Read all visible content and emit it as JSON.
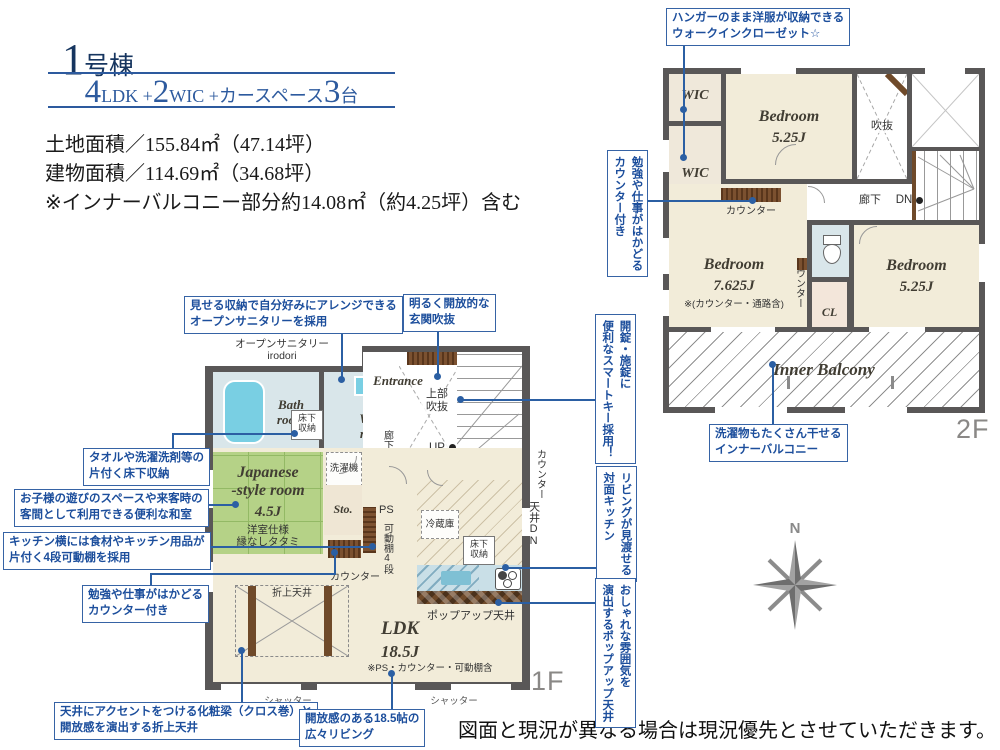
{
  "header": {
    "building_num": "1",
    "building_suffix": "号棟",
    "sub_n1": "4",
    "sub_u1": "LDK +",
    "sub_n2": "2",
    "sub_u2": "WIC +カースペース",
    "sub_n3": "3",
    "sub_u3": "台",
    "areas": "土地面積／155.84㎡（47.14坪）\n建物面積／114.69㎡（34.68坪）\n※インナーバルコニー部分約14.08㎡（約4.25坪）含む"
  },
  "floor2": {
    "label": "2F",
    "wic1": "WIC",
    "wic2": "WIC",
    "bed1_name": "Bedroom",
    "bed1_size": "5.25J",
    "void": "吹抜",
    "hall": "廊下",
    "dn": "DN",
    "counter_top": "カウンター",
    "bed2_name": "Bedroom",
    "bed2_size": "7.625J",
    "bed2_note": "※(カウンター・通路含)",
    "counter_side": "カウンター",
    "cl": "CL",
    "bed3_name": "Bedroom",
    "bed3_size": "5.25J",
    "balcony": "Inner Balcony"
  },
  "floor1": {
    "label": "1F",
    "sanitary_label": "オープンサニタリー\nirodori",
    "bath": "Bath\nroom",
    "wash": "Wash\nroom",
    "floor_storage1": "床下\n収納",
    "entrance": "Entrance",
    "upper_void": "上部\n吹抜",
    "hall": "廊下",
    "up": "UP",
    "washer": "洗濯機",
    "jp_name": "Japanese\n-style room",
    "jp_size": "4.5J",
    "jp_note": "洋室仕様\n縁なしタタミ",
    "sto1": "Sto.",
    "sto2": "Sto.",
    "ps": "PS",
    "shelf": "可動棚4段",
    "fridge": "冷蔵庫",
    "floor_storage2": "床下\n収納",
    "counter": "カウンター",
    "wc_counter": "カウンター",
    "ceiling_dn": "天井DN",
    "oriage": "折上天井",
    "ldk_name": "LDK",
    "ldk_size": "18.5J",
    "ldk_note": "※PS・カウンター・可動棚含",
    "popup": "ポップアップ天井",
    "shutter1": "シャッター",
    "shutter2": "シャッター"
  },
  "callouts": {
    "wic": "ハンガーのまま洋服が収納できる\nウォークインクローゼット☆",
    "study2f": "勉強や仕事がはかどる\nカウンター付き",
    "smartkey": "開錠・施錠に\n便利なスマートキー採用！",
    "kitchen_face": "リビングが見渡せる\n対面キッチン",
    "popup": "おしゃれな雰囲気を\n演出するポップアップ天井",
    "balcony": "洗濯物もたくさん干せる\nインナーバルコニー",
    "sanitary": "見せる収納で自分好みにアレンジできる\nオープンサニタリーを採用",
    "genkan": "明るく開放的な\n玄関吹抜",
    "yukashita": "タオルや洗濯洗剤等の\n片付く床下収納",
    "washitsu": "お子様の遊びのスペースや来客時の\n客間として利用できる便利な和室",
    "kadoudana": "キッチン横には食材やキッチン用品が\n片付く4段可動棚を採用",
    "study1f": "勉強や仕事がはかどる\nカウンター付き",
    "keshobari": "天井にアクセントをつける化粧梁（クロス巻）と\n開放感を演出する折上天井",
    "living": "開放感のある18.5帖の\n広々リビング"
  },
  "compass": {
    "n": "N"
  },
  "footer": {
    "disclaimer": "図面と現況が異なる場合は現況優先とさせていただきます。"
  },
  "colors": {
    "wall": "#595757",
    "floor": "#f2ecd9",
    "water": "#d9e6ea",
    "tub": "#79cfe3",
    "tatami": "#b5d287",
    "wood": "#6f4a2a",
    "callout_text": "#1c4e9c",
    "callout_border": "#3663a5",
    "title_navy": "#16355f",
    "accent_blue": "#2d5a9e"
  }
}
